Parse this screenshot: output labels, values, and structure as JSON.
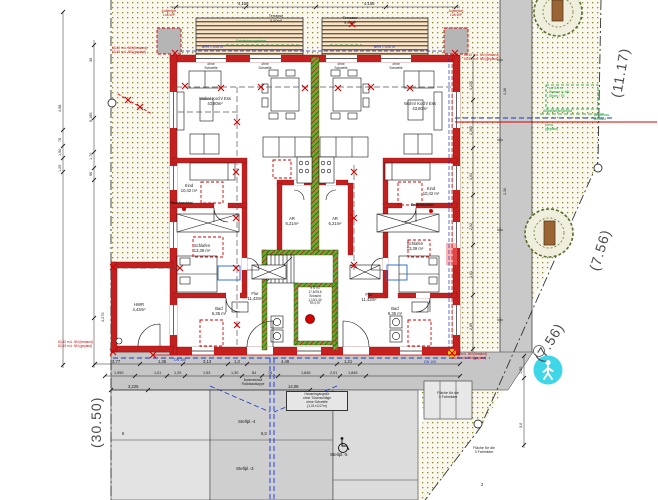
{
  "boundary": {
    "left": "(30.50)",
    "right_top": "(11.17)",
    "right_mid": "(7.56)",
    "right_low": "(7.56)"
  },
  "building": {
    "terrace": "Terrasse\n9,90m²",
    "threshold": "ohne\nSchwelle",
    "wohn": "Wohn/ Koch/ Ess\n43,80m²",
    "kind": "Kind\n10,42 m²",
    "schlafen": "Schlafen\n13,39 m²",
    "bad": "Bad\n6,35 m²",
    "flur": "Flur\n11,43m²",
    "hwr": "HWR\n4,43m²",
    "ar": "AR\n6,21m²",
    "rauchmelder": "Rauchmelder",
    "stair_spec": "9 STG\n17,6/28,6\nSchacht\n1,10/1,40\nTB 0,97",
    "heat_pump": "Aufstellort\nLuft-WP"
  },
  "notes": {
    "entrance": "Hauseingangstür\nohne Türanschläge\nohne Schwelle\n(1,01×2,07m)",
    "level_bottom_left": "63,40 m ü. NN (bestand)\n63,45 m ü. NN (geplant)",
    "level_bottom_right": "63,50 m ü. NN (bestand)\n63,45 m ü. NN (geplant)",
    "level_top_left": "63,40 m ü. NN (bestand)\n63,45 m ü. NN (geplant)",
    "level_top_right": "63,40 m ü. NN (bestand)\n63,45 m ü. NN (geplant)",
    "brh": "BRH = 0,00 m",
    "rinne": "Entwässerungsrinne",
    "bodeneinlauf": "Bodeneinlauf\nRückstauklappe",
    "dn100": "DN 100",
    "utility_box": "ca. 5,0 m\nWasser ü. NN\nStrom / TK",
    "utility_note": "Abwasseranschluss",
    "anschluss": "Anschluss\nBestand",
    "keva": "KeVa\n(geplant)"
  },
  "parking": {
    "p4": "Stellpl.-4",
    "p3": "Stellpl.-3",
    "p5": "Stellpl.-5",
    "bike": "Fläche für die\n3 Fahrräder"
  },
  "dims": {
    "top": [
      "4,155",
      "4,155"
    ],
    "left_outer": [
      "4,98",
      "76",
      "1,50",
      "1,25"
    ],
    "left_inner": [
      "35",
      "5,185",
      "1,70",
      "96",
      "4,275"
    ],
    "right_side": [
      "1,235",
      "2,385",
      "1,01",
      "2,52",
      "1,01",
      "2,89"
    ],
    "row1": [
      "3,77",
      "1,36",
      "3,13",
      "1,3",
      "4,48",
      "1,21"
    ],
    "row2": [
      "1,955",
      "1,01",
      "1,25",
      "1,53",
      "1,30",
      "84",
      "76",
      "1,845",
      "2,01",
      "1,845"
    ],
    "row3": [
      "3,225",
      "14,08"
    ],
    "road": [
      "1,36",
      "1,30"
    ],
    "right_low": [
      "1,50",
      "3,0"
    ],
    "park": [
      "6",
      "6,0",
      "2"
    ]
  },
  "icons": {
    "wheelchair": "wheelchair-icon",
    "pedestrian": "pedestrian-icon",
    "tree": "tree-icon",
    "smoke_detector": "smoke-detector-dot-icon"
  },
  "colors": {
    "wall_red": "#c42020",
    "party_green": "#58b32e",
    "utility_blue": "#1a35cc",
    "marker_red": "#d40000",
    "site_cyan": "#3fd6e8",
    "note_green": "#009933"
  }
}
